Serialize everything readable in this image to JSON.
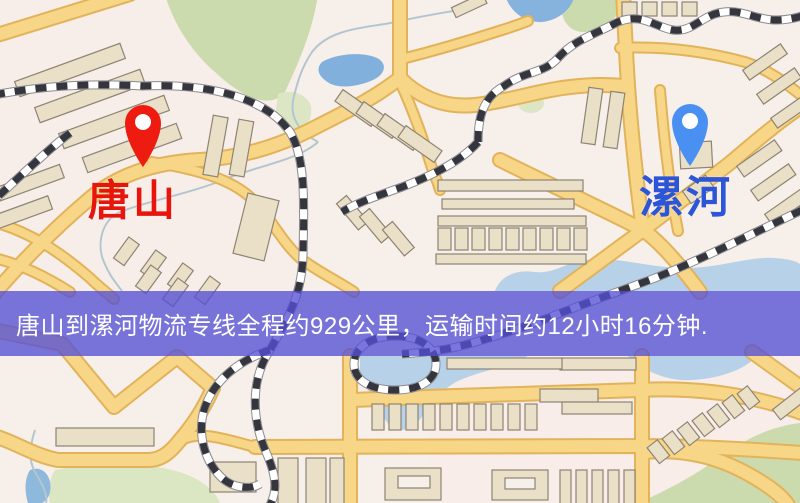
{
  "map": {
    "markers": [
      {
        "id": "origin",
        "label": "唐山",
        "pin_color": "#ee1c10",
        "label_color": "#e8150d"
      },
      {
        "id": "destination",
        "label": "漯河",
        "pin_color": "#4a90f2",
        "label_color": "#2c55d8"
      }
    ],
    "banner": {
      "text": "唐山到漯河物流专线全程约929公里，运输时间约12小时16分钟.",
      "background_color": "#5550d5",
      "text_color": "#ffffff",
      "details": {
        "origin": "唐山",
        "destination": "漯河",
        "service": "物流专线",
        "distance": "约929公里",
        "transport_time": "约12小时16分钟"
      }
    },
    "legend_colors": {
      "background": "#f7efe9",
      "road": "#f7d688",
      "road_edge": "#e2b35a",
      "water": "#85b3de",
      "park": "#ccdbae",
      "building": "#eae0c8",
      "railway": "#35353d"
    }
  }
}
